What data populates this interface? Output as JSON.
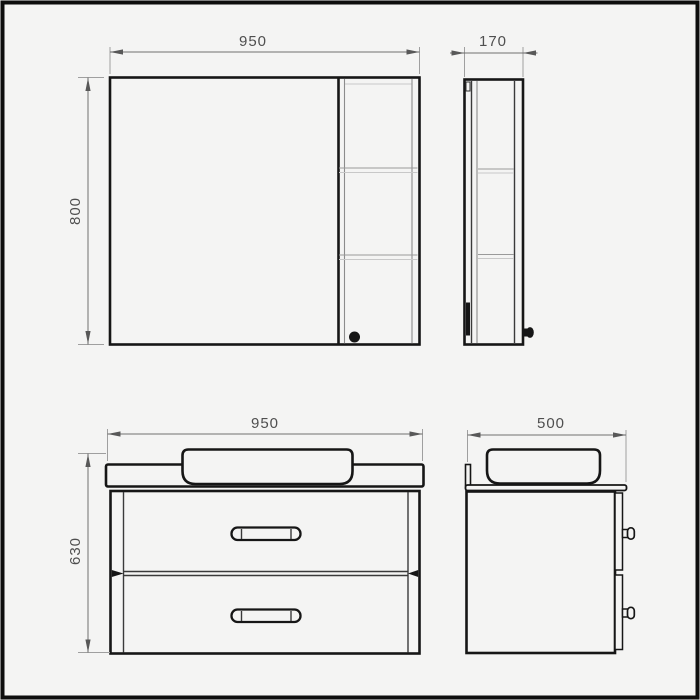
{
  "page": {
    "background": "#f4f4f3",
    "frame_color": "#0d0d0d"
  },
  "drawing": {
    "type": "technical-dimension-drawing",
    "subject": "bathroom furniture set: mirror cabinet (front and side views) and vanity unit with countertop basin and two drawers (front and side views)",
    "units": "mm",
    "colors": {
      "object_line": "#161616",
      "dimension_line": "#6f6f6f",
      "extension_line": "#9f9f9f",
      "shelf_line": "#9a9a9a",
      "text": "#4f4f4f"
    },
    "views": [
      {
        "name": "mirror-cabinet-front",
        "width_mm": "950",
        "height_mm": "800",
        "features": [
          "mirror door",
          "open shelf column with two shelves",
          "round knob bottom of shelf column"
        ]
      },
      {
        "name": "mirror-cabinet-side",
        "depth_mm": "170",
        "features": [
          "two shelves",
          "wall bracket",
          "knob"
        ]
      },
      {
        "name": "vanity-front",
        "width_mm": "950",
        "height_mm": "630",
        "features": [
          "countertop",
          "vessel basin",
          "two drawers with bar handles"
        ]
      },
      {
        "name": "vanity-side",
        "depth_mm": "500",
        "features": [
          "backsplash upstand",
          "vessel basin",
          "two drawer fronts with knobs"
        ]
      }
    ]
  }
}
